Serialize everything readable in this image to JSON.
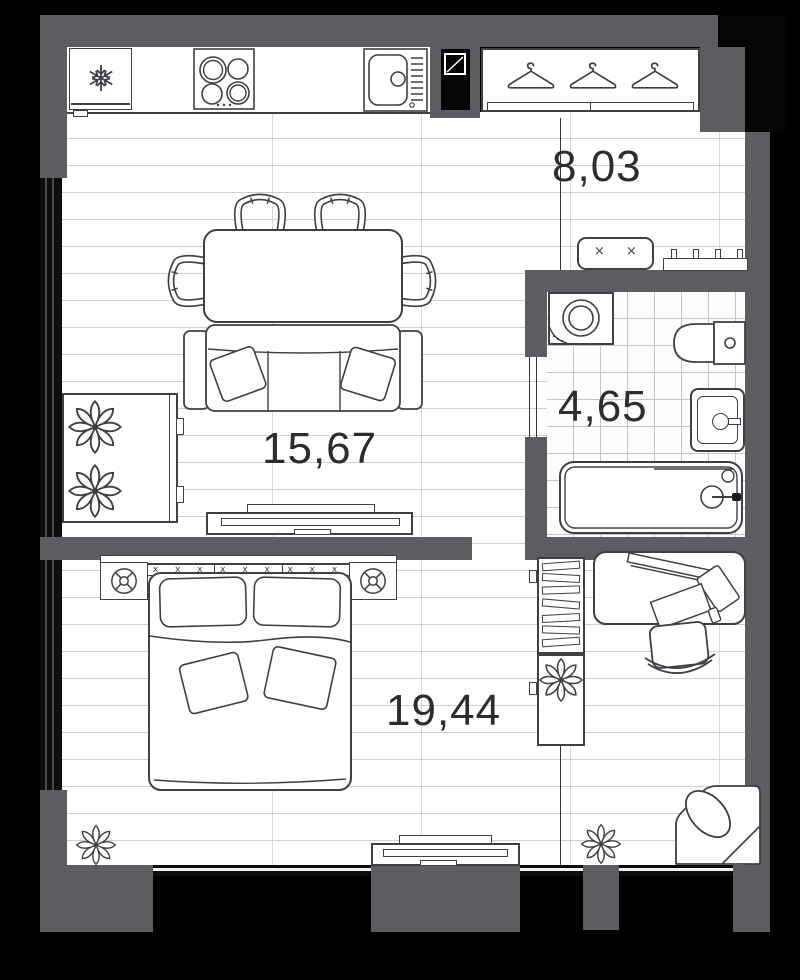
{
  "floor_plan": {
    "rooms": [
      {
        "id": "hallway",
        "area_label": "8,03"
      },
      {
        "id": "bathroom",
        "area_label": "4,65"
      },
      {
        "id": "kitchen-living-room",
        "area_label": "15,67"
      },
      {
        "id": "bedroom",
        "area_label": "19,44"
      }
    ],
    "colors": {
      "outside": "#000000",
      "wall": "#5d5d61",
      "floor": "#ffffff",
      "plank_line": "#ccd0d3",
      "tile_line": "#c2c6c9",
      "furniture_stroke": "#3e4045",
      "label_text": "#2b2d31"
    },
    "furniture": [
      "refrigerator",
      "cooktop",
      "kitchen-sink",
      "vent-shaft",
      "entry-wardrobe",
      "bench",
      "shoe-rack",
      "washing-machine",
      "toilet",
      "washbasin",
      "bathtub",
      "plant-console",
      "dining-table",
      "dining-chairs",
      "sofa",
      "tv-console-living",
      "double-bed",
      "nightstands",
      "bookshelf",
      "plant-cabinet",
      "desk",
      "desk-chair",
      "tv-console-bedroom",
      "armchair",
      "plants"
    ]
  }
}
